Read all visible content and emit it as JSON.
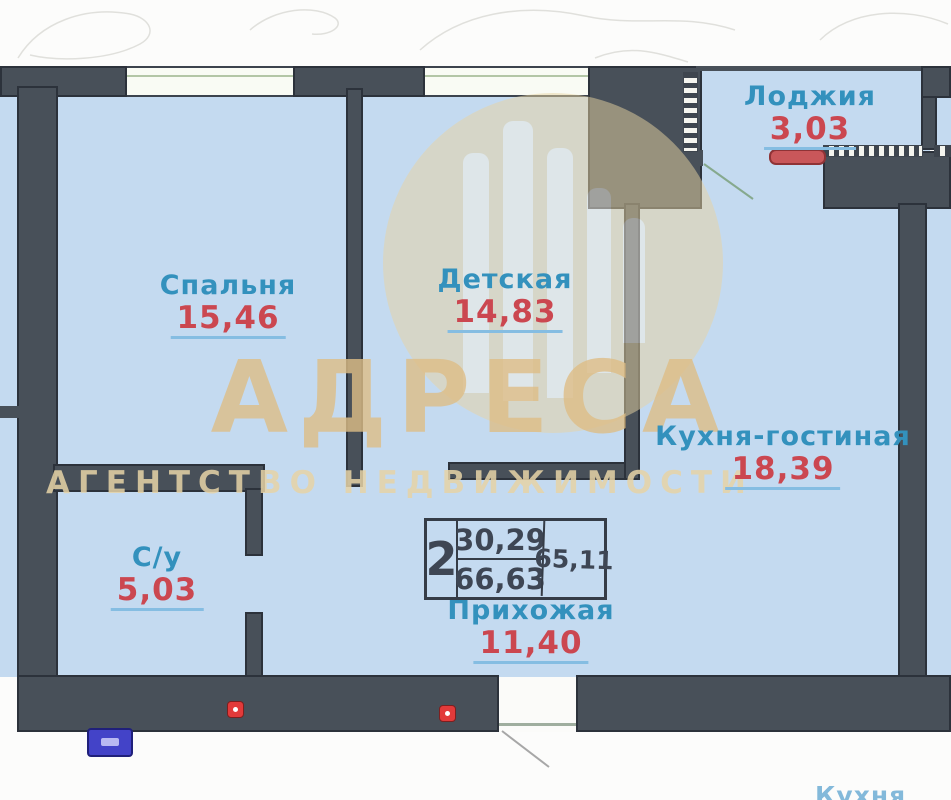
{
  "plan": {
    "rooms": [
      {
        "key": "bedroom",
        "name": "Спальня",
        "area": "15,46"
      },
      {
        "key": "children",
        "name": "Детская",
        "area": "14,83"
      },
      {
        "key": "loggia",
        "name": "Лоджия",
        "area": "3,03"
      },
      {
        "key": "kitchen_living",
        "name": "Кухня-гостиная",
        "area": "18,39"
      },
      {
        "key": "bathroom",
        "name": "С/у",
        "area": "5,03"
      },
      {
        "key": "hallway",
        "name": "Прихожая",
        "area": "11,40"
      }
    ],
    "stamp": {
      "rooms_count": "2",
      "area_top": "30,29",
      "area_bottom": "66,63",
      "area_side": "65,11"
    },
    "watermark": {
      "title": "АДРЕСА",
      "subtitle": "АГЕНТСТВО НЕДВИЖИМОСТИ"
    },
    "neighbor_fragment": "Кухня",
    "colors": {
      "wall": "#485059",
      "room_fill": "#c4daf0",
      "label_name": "#3391bd",
      "label_area": "#cb4750",
      "watermark": "#debe87",
      "radiator": "#c9575a",
      "alarm_dot": "#e23a3a"
    }
  }
}
